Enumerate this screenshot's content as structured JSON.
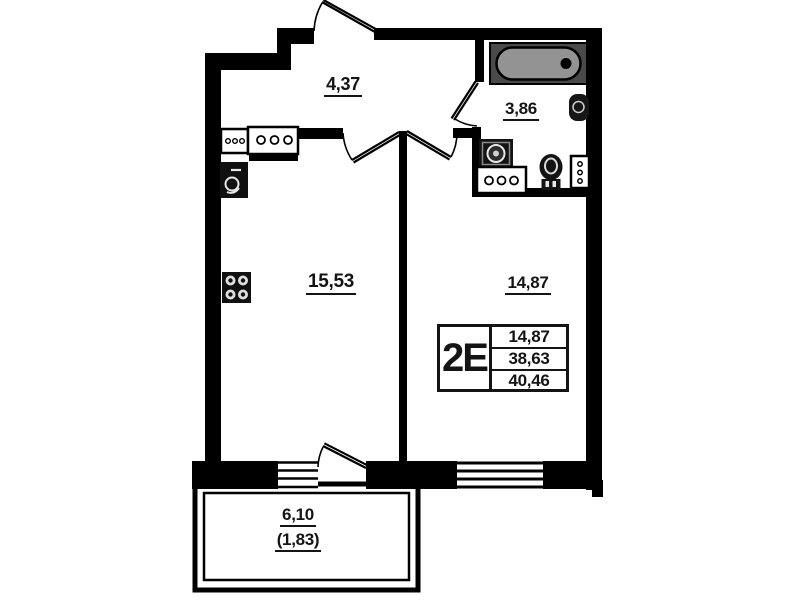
{
  "plan": {
    "rooms": [
      {
        "name": "hallway",
        "area": "4,37"
      },
      {
        "name": "bathroom",
        "area": "3,86"
      },
      {
        "name": "kitchen-living-room",
        "area": "15,53"
      },
      {
        "name": "room",
        "area": "14,87"
      },
      {
        "name": "balcony",
        "area": "6,10",
        "area_with_coefficient": "(1,83)"
      }
    ],
    "info_table": {
      "type_label": "2E",
      "rows": [
        "14,87",
        "38,63",
        "40,46"
      ]
    },
    "colors": {
      "wall": "#000000",
      "background": "#ffffff",
      "bathtub_outer": "#4a4a4a",
      "bathtub_inner": "#939393"
    }
  }
}
